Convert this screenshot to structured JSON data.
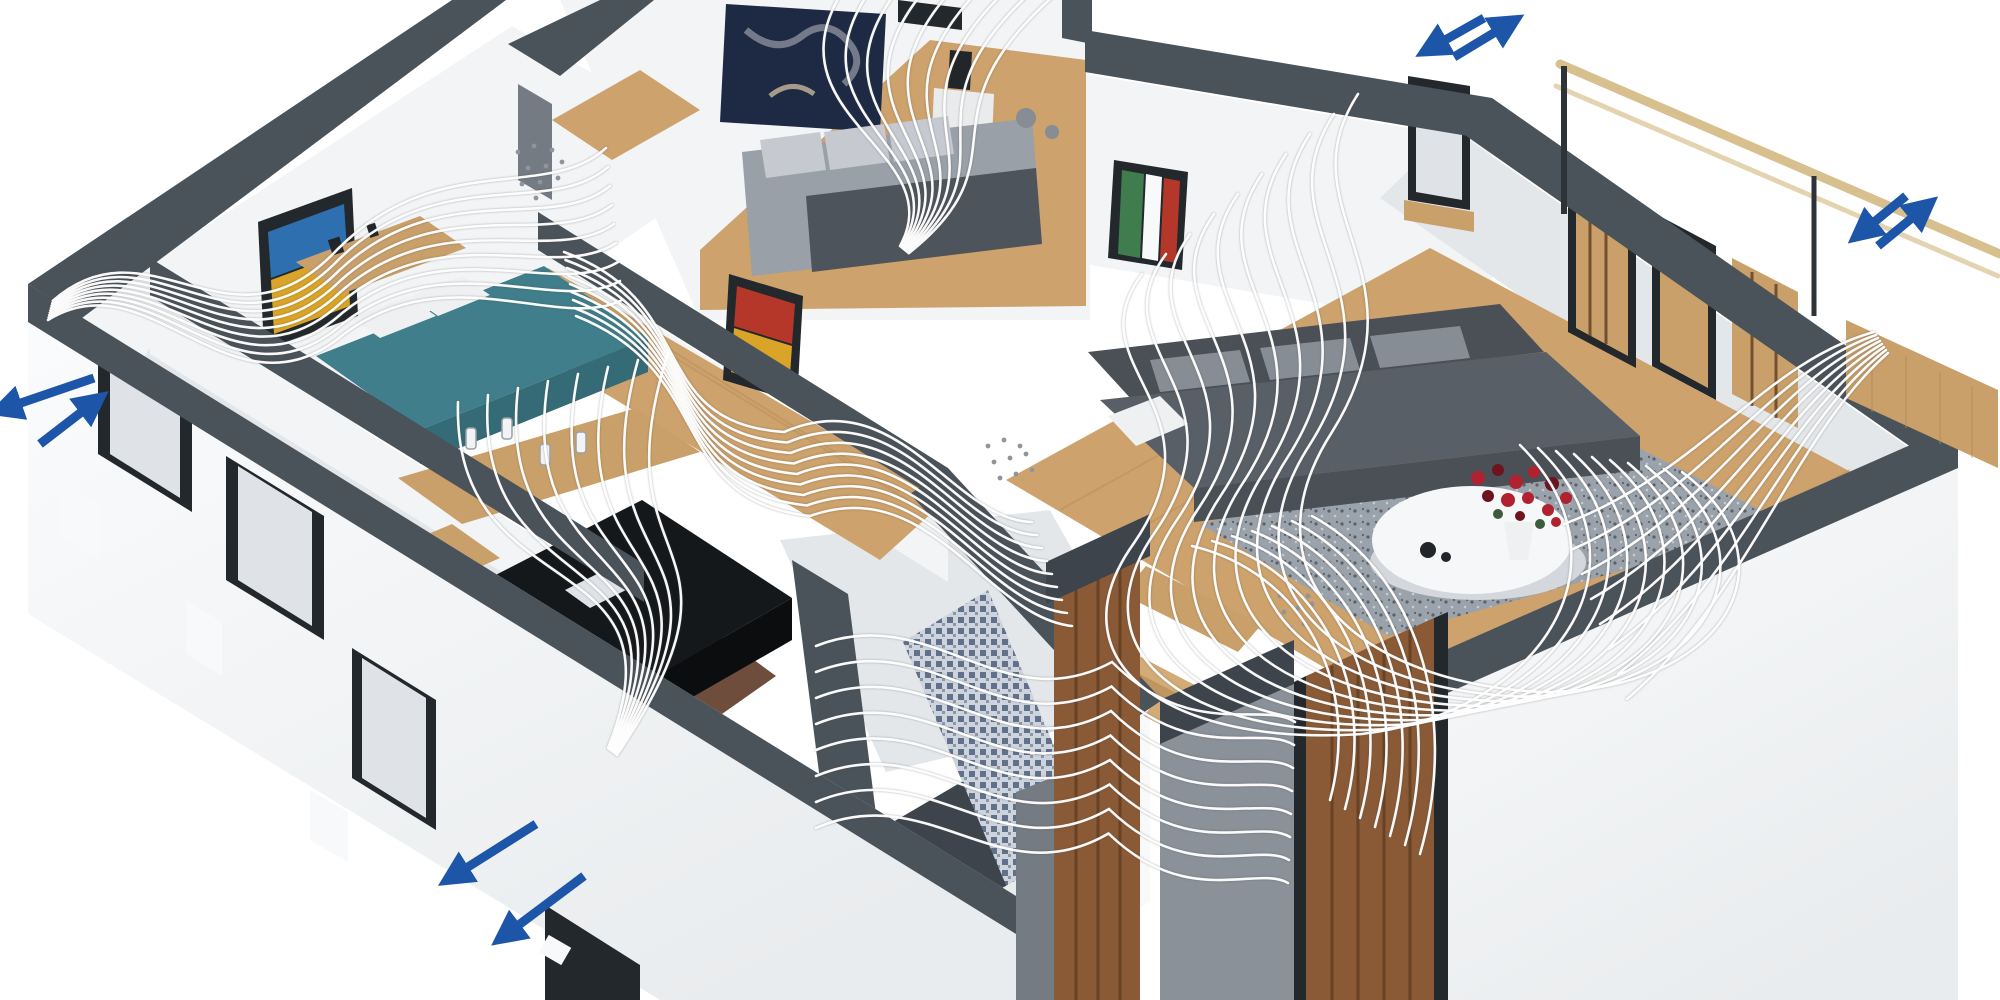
{
  "meta": {
    "description": "3D cutaway illustration of a single-storey apartment with comfort ventilation: white airflow streamlines sweep through every room and blue double arrows mark supply and exhaust air points through the exterior walls."
  },
  "scene": {
    "rooms": [
      {
        "id": "bedroom-1",
        "contents": "bedroom with teal bed, wooden sideboard and abstract wall art"
      },
      {
        "id": "bedroom-2",
        "contents": "bedroom with gray bed, white nightstand, black lamp and dark wall art"
      },
      {
        "id": "kitchen",
        "contents": "kitchen with wooden counters, bottles and black island"
      },
      {
        "id": "hallway",
        "contents": "wooden-floor hallway with colorful picture"
      },
      {
        "id": "bathroom",
        "contents": "bathroom with blue mosaic shower wall"
      },
      {
        "id": "stairs",
        "contents": "wooden staircase"
      },
      {
        "id": "living-room",
        "contents": "living room with charcoal sofa, gray rug, round white table with red flowers"
      },
      {
        "id": "entrance",
        "contents": "entrance with walnut front door"
      },
      {
        "id": "balcony",
        "contents": "balcony with tan handrail and wood deck"
      }
    ]
  },
  "colors": {
    "background": "#ffffff",
    "wall_cap": "#4a525a",
    "wall_cap_dark": "#3d444c",
    "wall_face": "#f2f4f6",
    "wall_face_shade": "#e4e7ea",
    "facade": "#e9ecee",
    "facade_bright": "#fbfcfd",
    "window_frame": "#23282d",
    "window_glass": "#dfe3e7",
    "sill_white": "#f8f9fa",
    "wood_floor": "#cda26c",
    "wood_dark": "#b68a55",
    "wood_counter": "#c9a06a",
    "door_wood": "#8a5a36",
    "door_wood_dark": "#5f3c22",
    "kitchen_island": "#15181b",
    "kitchen_island_side": "#0b0d0f",
    "floor_brown": "#6f4d3c",
    "tile_white": "#e9ebed",
    "bed_teal": "#3f7e8a",
    "bed_teal_dark": "#356b76",
    "pillow_white": "#eef0f2",
    "mattress_gray": "#9aa0a8",
    "duvet_gray": "#4e545b",
    "pillow_gray": "#c6cad0",
    "sofa_dark": "#4a5056",
    "sofa_mid": "#595f66",
    "cushion_gray": "#868d95",
    "rug_base": "#9aa2ab",
    "rug_dot": "#5a6168",
    "rug_light": "#c6ccd2",
    "table_white": "#f6f7f8",
    "table_shadow": "#d4d8dd",
    "flowers_red": "#b02230",
    "flowers_dark": "#6e1420",
    "leaf_green": "#3c5a3c",
    "mosaic_base": "#cdd4de",
    "mosaic_dot": "#61718a",
    "mosaic_dot2": "#8b97a8",
    "stairs_a": "#d3ab77",
    "stairs_b": "#bf9660",
    "railing_tan": "#d8c08e",
    "post_dark": "#2e3338",
    "entry_recess": "#8a9199",
    "side_gray": "#747b83",
    "art_navy": "#1e2a44",
    "art_blue": "#2e6fb0",
    "art_yellow": "#d9a427",
    "art_red": "#b5372a",
    "art_green": "#3f7d4f",
    "deco_dark": "#22262a",
    "flow_line": "#ffffff",
    "arrow_blue": "#1d56a8",
    "dots_gray": "#8e959c"
  },
  "airflow_markers": [
    {
      "group": "airflow-arrows-top-right-icon",
      "meaning": "air exchange through rear living-room wall",
      "arrows": [
        {
          "from": [
            1484,
            18
          ],
          "to": [
            1438,
            44
          ]
        },
        {
          "from": [
            1454,
            57
          ],
          "to": [
            1502,
            28
          ]
        }
      ]
    },
    {
      "group": "airflow-arrows-right-icon",
      "meaning": "air exchange through balcony wall",
      "arrows": [
        {
          "from": [
            1906,
            196
          ],
          "to": [
            1868,
            227
          ]
        },
        {
          "from": [
            1878,
            246
          ],
          "to": [
            1918,
            213
          ]
        }
      ]
    },
    {
      "group": "airflow-arrows-left-icon",
      "meaning": "air exchange through left exterior wall",
      "arrows": [
        {
          "from": [
            94,
            378
          ],
          "to": [
            12,
            406
          ]
        },
        {
          "from": [
            40,
            444
          ],
          "to": [
            88,
            407
          ]
        }
      ]
    },
    {
      "group": "airflow-arrows-bottom-icon",
      "meaning": "exhaust air out through front wall",
      "arrows": [
        {
          "from": [
            536,
            824
          ],
          "to": [
            460,
            872
          ]
        },
        {
          "from": [
            584,
            876
          ],
          "to": [
            512,
            930
          ]
        }
      ]
    }
  ],
  "flows": [
    {
      "name": "flow-bedroom-1",
      "count": 9,
      "spread_start": [
        0.6,
        -2.4
      ],
      "spread_end": [
        -2,
        -19
      ],
      "points": [
        [
          48,
          320
        ],
        [
          150,
          256
        ],
        [
          232,
          428
        ],
        [
          344,
          334
        ],
        [
          448,
          256
        ],
        [
          560,
          332
        ],
        [
          622,
          300
        ]
      ]
    },
    {
      "name": "flow-bedroom-2",
      "count": 9,
      "spread_start": [
        27,
        0
      ],
      "spread_end": [
        1.1,
        0.9
      ],
      "points": [
        [
          842,
          -8
        ],
        [
          766,
          116
        ],
        [
          952,
          152
        ],
        [
          900,
          246
        ]
      ]
    },
    {
      "name": "flow-hallway",
      "count": 9,
      "spread_start": [
        1.5,
        8
      ],
      "spread_end": [
        5,
        13
      ],
      "points": [
        [
          564,
          252
        ],
        [
          702,
          302
        ],
        [
          644,
          422
        ],
        [
          784,
          432
        ],
        [
          900,
          382
        ],
        [
          952,
          520
        ],
        [
          1032,
          522
        ]
      ]
    },
    {
      "name": "flow-kitchen",
      "count": 8,
      "spread_start": [
        30,
        -7
      ],
      "spread_end": [
        1.3,
        1
      ],
      "points": [
        [
          458,
          402
        ],
        [
          452,
          612
        ],
        [
          692,
          540
        ],
        [
          608,
          748
        ]
      ]
    },
    {
      "name": "flow-bathroom",
      "count": 8,
      "spread_start": [
        0,
        26
      ],
      "spread_end": [
        -1,
        23
      ],
      "points": [
        [
          816,
          646
        ],
        [
          932,
          600
        ],
        [
          1002,
          722
        ],
        [
          1112,
          662
        ],
        [
          1192,
          742
        ],
        [
          1262,
          700
        ],
        [
          1295,
          722
        ]
      ]
    },
    {
      "name": "flow-stairs",
      "count": 7,
      "spread_start": [
        20,
        -5
      ],
      "spread_end": [
        15,
        9
      ],
      "points": [
        [
          1192,
          546
        ],
        [
          1302,
          572
        ],
        [
          1362,
          682
        ],
        [
          1330,
          800
        ]
      ]
    },
    {
      "name": "flow-living-main",
      "count": 10,
      "spread_start": [
        -24,
        20
      ],
      "spread_end": [
        -18,
        -3
      ],
      "points": [
        [
          1358,
          94
        ],
        [
          1282,
          210
        ],
        [
          1432,
          272
        ],
        [
          1332,
          432
        ],
        [
          1242,
          572
        ],
        [
          1352,
          682
        ],
        [
          1542,
          692
        ],
        [
          1722,
          692
        ],
        [
          1802,
          562
        ],
        [
          1682,
          472
        ]
      ]
    },
    {
      "name": "flow-living-balcony",
      "count": 8,
      "spread_start": [
        2,
        3
      ],
      "spread_end": [
        9,
        25
      ],
      "points": [
        [
          1874,
          332
        ],
        [
          1764,
          362
        ],
        [
          1702,
          472
        ],
        [
          1564,
          524
        ]
      ]
    }
  ],
  "vent_dots": [
    {
      "group": "vent-dots-1",
      "points": [
        [
          518,
          152
        ],
        [
          534,
          146
        ],
        [
          552,
          150
        ],
        [
          528,
          168
        ],
        [
          546,
          166
        ],
        [
          562,
          162
        ],
        [
          522,
          184
        ],
        [
          540,
          182
        ],
        [
          558,
          178
        ],
        [
          536,
          198
        ]
      ]
    },
    {
      "group": "vent-dots-2",
      "points": [
        [
          988,
          446
        ],
        [
          1004,
          440
        ],
        [
          1020,
          446
        ],
        [
          994,
          462
        ],
        [
          1010,
          458
        ],
        [
          1026,
          454
        ],
        [
          1000,
          478
        ],
        [
          1016,
          474
        ],
        [
          1032,
          470
        ]
      ]
    },
    {
      "group": "vent-dots-3",
      "points": [
        [
          1280,
          596
        ],
        [
          1294,
          590
        ],
        [
          1308,
          596
        ],
        [
          1284,
          612
        ],
        [
          1298,
          608
        ],
        [
          1312,
          604
        ],
        [
          1290,
          628
        ],
        [
          1304,
          624
        ]
      ]
    }
  ]
}
